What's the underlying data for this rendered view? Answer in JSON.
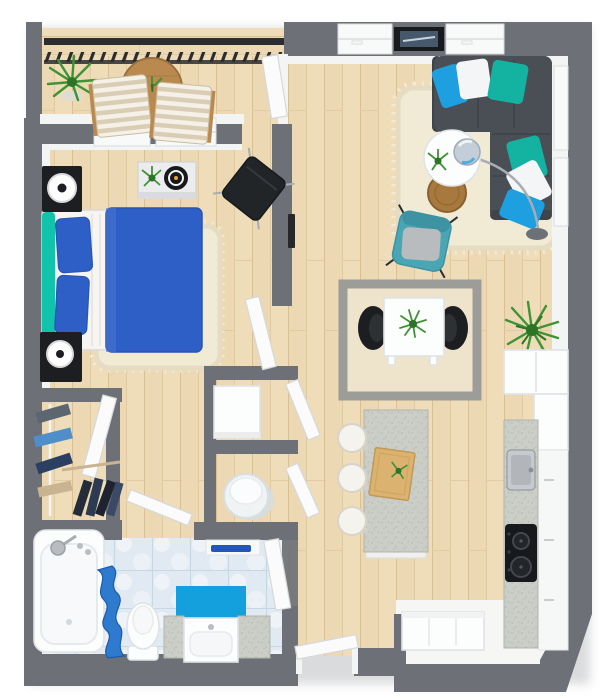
{
  "scene": {
    "type": "3d-floor-plan-top-view",
    "rooms": [
      {
        "id": "balcony",
        "label": "Balcony",
        "items": [
          "railing",
          "potted-palm",
          "round-wood-table",
          "table-plant",
          "lounge-chair-left",
          "lounge-chair-right"
        ]
      },
      {
        "id": "living-room",
        "label": "Living Room",
        "items": [
          "sectional-sofa",
          "six-throw-pillows",
          "shag-rug",
          "round-coffee-table",
          "coffee-table-plant",
          "arc-floor-lamp",
          "wood-side-table",
          "teal-armchair",
          "wall-picture",
          "windows"
        ]
      },
      {
        "id": "dining-area",
        "label": "Dining Area",
        "items": [
          "bordered-rug",
          "white-dining-table",
          "black-dining-chair-left",
          "black-dining-chair-right",
          "centerpiece-plant",
          "palm-plant"
        ]
      },
      {
        "id": "kitchen",
        "label": "Kitchen",
        "items": [
          "tall-cabinets",
          "counter-run",
          "sink",
          "cooktop",
          "kitchen-island",
          "serving-tray",
          "bar-stool-1",
          "bar-stool-2",
          "bar-stool-3",
          "storage-bench"
        ]
      },
      {
        "id": "bedroom",
        "label": "Bedroom",
        "items": [
          "double-bed",
          "teal-headboard",
          "blue-pillows",
          "blue-duvet",
          "shag-rug",
          "nightstand-top",
          "nightstand-bottom",
          "round-lamp-top",
          "round-lamp-bottom",
          "dresser",
          "dresser-plant",
          "round-speaker",
          "black-lounge-chair",
          "wall-tv-edge"
        ]
      },
      {
        "id": "walk-in-closet",
        "label": "Walk-in Closet",
        "items": [
          "clothes-rail",
          "hanging-clothes"
        ]
      },
      {
        "id": "hall-closet-a",
        "label": "Hall Closet A",
        "items": [
          "storage-cabinet"
        ]
      },
      {
        "id": "hall-closet-b",
        "label": "Hall Closet B",
        "items": [
          "laundry-basket"
        ]
      },
      {
        "id": "bathroom",
        "label": "Bathroom",
        "items": [
          "bathtub",
          "tub-faucet",
          "shower-curtain",
          "toilet",
          "vanity-sink",
          "bath-mat",
          "towel-shelf"
        ]
      },
      {
        "id": "hallway",
        "label": "Entry Hallway",
        "items": [
          "entry-door"
        ]
      }
    ],
    "doors": [
      "balcony-door",
      "bedroom-door",
      "closet-a-door",
      "closet-b-door",
      "walkin-closet-door",
      "bathroom-door",
      "parked-bathroom-door",
      "entry-door"
    ]
  },
  "colors": {
    "wall": "#6d7177",
    "wallFace": "#f3f4f4",
    "shadow": "#d4d5d7",
    "floorWood": "#ecd9b4",
    "plankLine": "#d9c094",
    "plankLight": "#f1e0bd",
    "plankSeam": "#e2cba2",
    "tile": "#e1eaf2",
    "tileLine": "#c6d7e4",
    "rug": "#f1ebd6",
    "rugEdge": "#e5dcc1",
    "diningRug": "#eee3cb",
    "diningRugBorder": "#9c9d99",
    "sofa": "#4a4e55",
    "sofaSeam": "#3f434a",
    "teal": "#14b3a1",
    "azure": "#1ea0e0",
    "pillowWhite": "#f3f5f6",
    "bedBlue": "#2d5fc6",
    "bedBlueEdge": "#2a55b2",
    "bedWhite": "#f3f2ee",
    "headboardTeal": "#12c3ac",
    "chairTeal": "#4aa5b5",
    "chairTealDark": "#3d93a2",
    "cushionGray": "#b9bcbe",
    "black": "#1c1e21",
    "charcoal": "#222528",
    "woodBrown": "#b9894f",
    "woodBrownDark": "#9c7040",
    "trayWood": "#dcb271",
    "trayEdge": "#c19a55",
    "plantGreen": "#3e9334",
    "plantDark": "#2d7427",
    "counter": "#cbcdc7",
    "counterDot": "#b5b7b1",
    "counterEdge": "#b2b4ae",
    "fixtureWhite": "#fcfdfd",
    "fixtureEdge": "#dfe3e7",
    "chrome": "#a7adb3",
    "curtainBlue": "#2e7ace",
    "curtainFold": "#1b5cab",
    "matBlue": "#149fdd",
    "towelBlue": "#2356b8",
    "door": "#fbfbfb",
    "doorEdge": "#d6d8d9",
    "windowWhite": "#f8f9f9",
    "windowEdge": "#d9dcde",
    "railBlack": "#2b2d2f",
    "stoolWhite": "#f5f3ed",
    "stoolEdge": "#d8d4c9",
    "clothNavy": "#2c3f63",
    "clothBlue": "#4f8ec9",
    "clothTan": "#c9b391",
    "clothDark": "#232c38",
    "pictureFrame": "#17191c",
    "pictureImage": "#46586c",
    "nookFloor": "#f6f6f5"
  }
}
